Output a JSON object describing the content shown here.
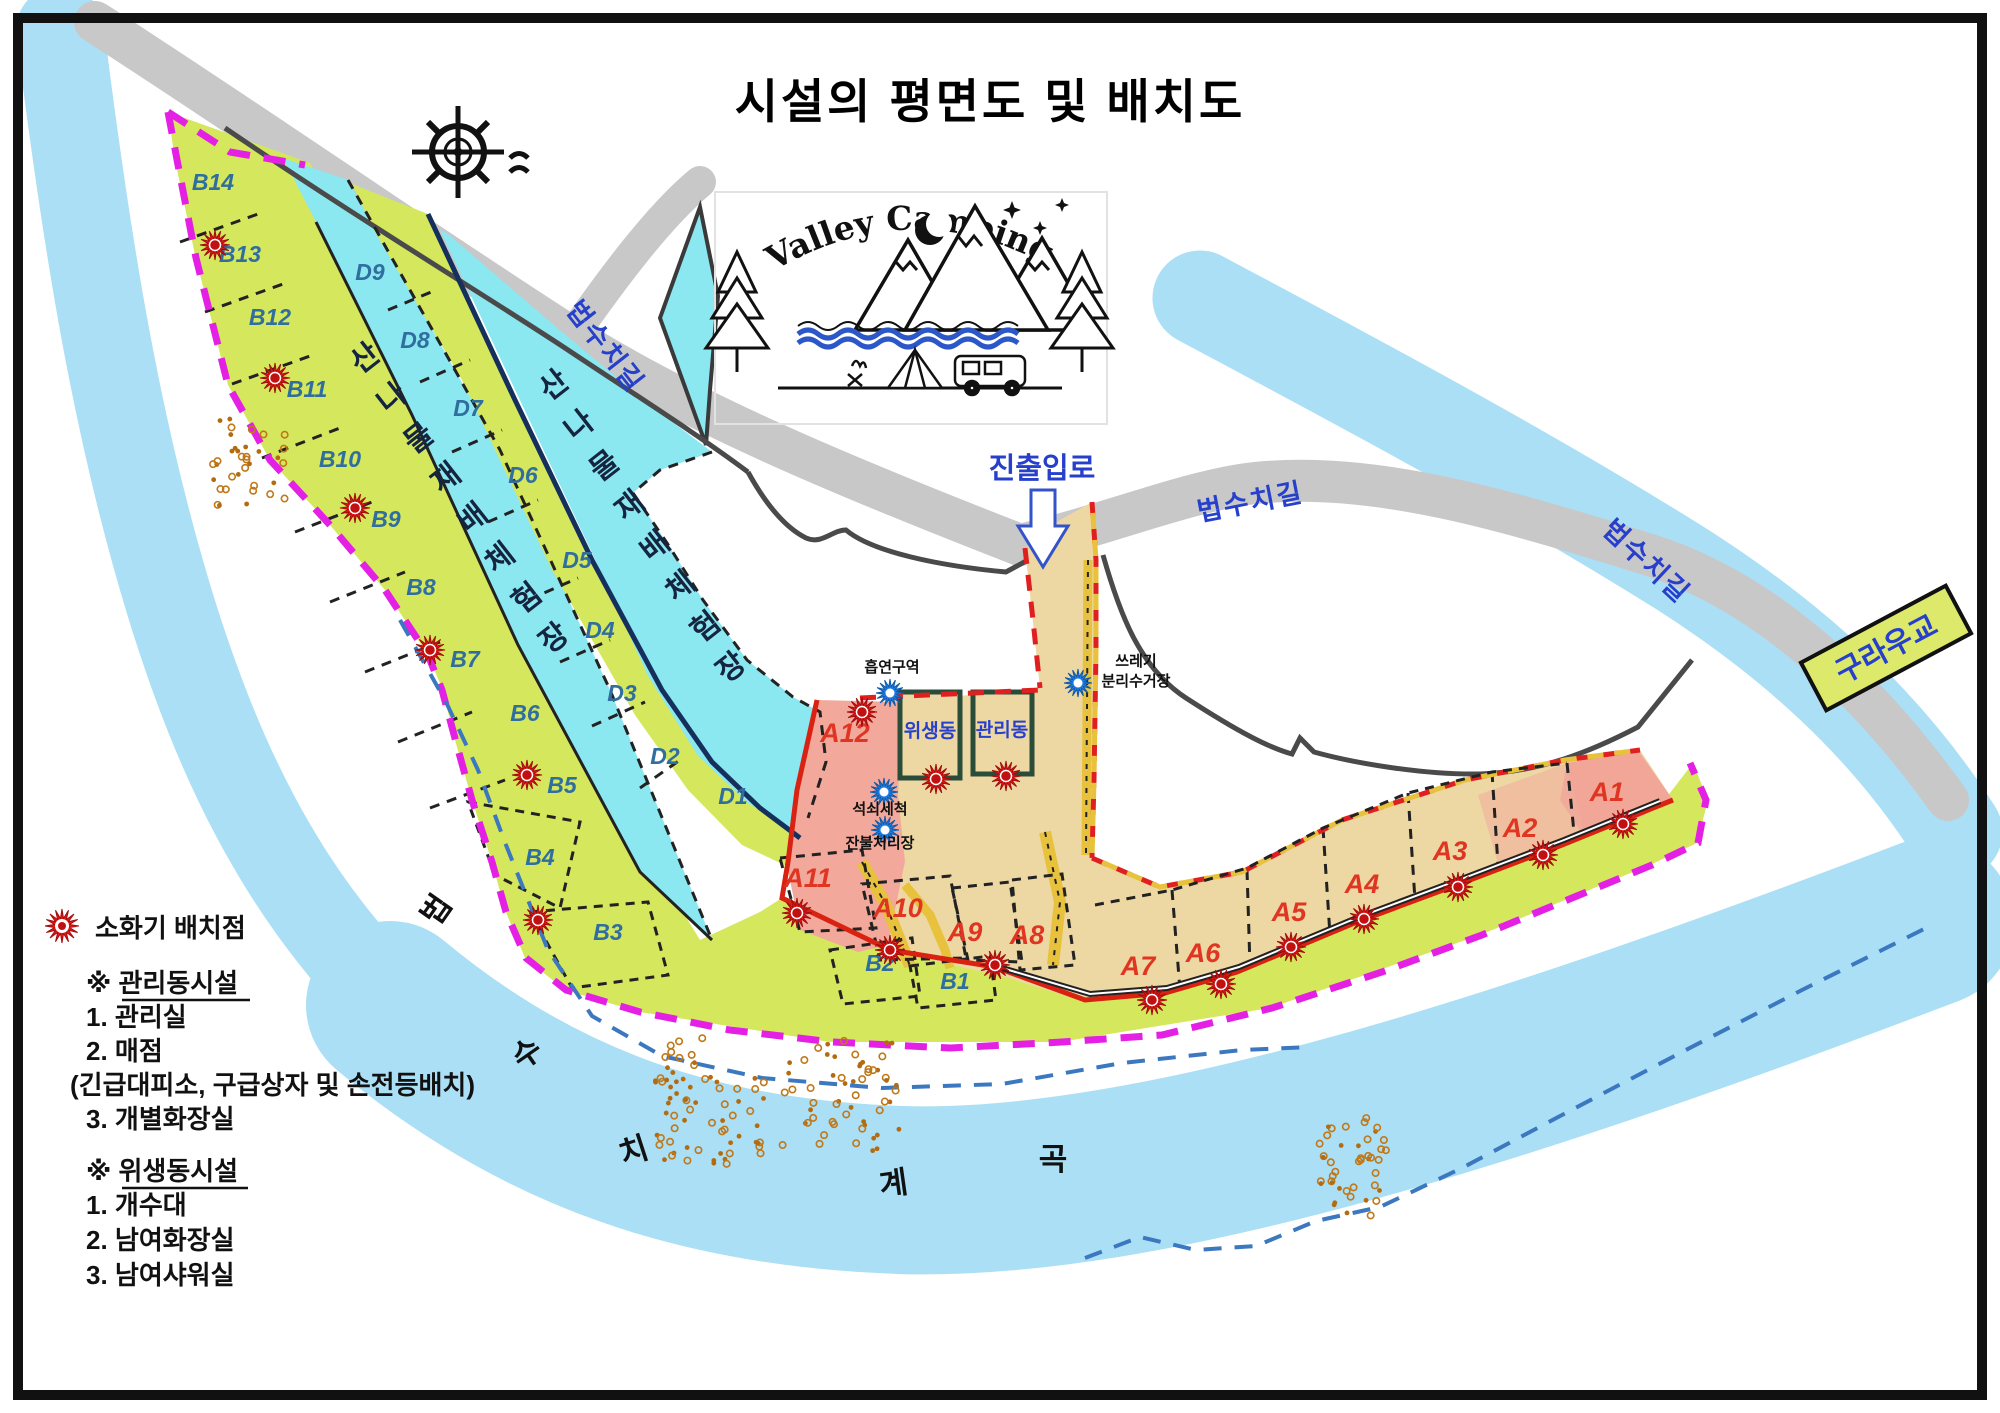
{
  "title": "시설의 평면도 및 배치도",
  "logo": {
    "name": "Valley Camping"
  },
  "roads": {
    "beopsuchi_1": "법수치길",
    "beopsuchi_2": "법수치길",
    "beopsuchi_3": "법수치길",
    "entrance": "진출입로",
    "bridge": "구라우교"
  },
  "river": {
    "name": "법수치계곡"
  },
  "areas": {
    "experience_1": "산나물재배체험장",
    "experience_2": "산나물재배체험장"
  },
  "buildings": {
    "sanitation": "위생동",
    "management": "관리동"
  },
  "poi": {
    "smoking": "흡연구역",
    "trash_line1": "쓰레기",
    "trash_line2": "분리수거장",
    "dishwash": "석쇠세척",
    "ember": "잔불처리장"
  },
  "sites": {
    "a": [
      "A1",
      "A2",
      "A3",
      "A4",
      "A5",
      "A6",
      "A7",
      "A8",
      "A9",
      "A10",
      "A11",
      "A12"
    ],
    "b": [
      "B1",
      "B2",
      "B3",
      "B4",
      "B5",
      "B6",
      "B7",
      "B8",
      "B9",
      "B10",
      "B11",
      "B12",
      "B13",
      "B14"
    ],
    "d": [
      "D1",
      "D2",
      "D3",
      "D4",
      "D5",
      "D6",
      "D7",
      "D8",
      "D9"
    ]
  },
  "legend": {
    "fire_ext": "소화기 배치점",
    "mgmt_title": "※ 관리동시설",
    "mgmt_items": [
      "1. 관리실",
      "2. 매점",
      "(긴급대피소, 구급상자 및 손전등배치)",
      "3. 개별화장실"
    ],
    "sani_title": "※ 위생동시설",
    "sani_items": [
      "1. 개수대",
      "2. 남여화장실",
      "3. 남여샤워실"
    ]
  },
  "colors": {
    "river": "#ABDFF5",
    "road": "#C8C8C8",
    "green": "#D5E75C",
    "cyan": "#8BE7F0",
    "tan": "#EDD7A2",
    "salmon": "#F2A89A",
    "magenta": "#E320E3",
    "red_line": "#D92211",
    "marker_red": "#E81515",
    "marker_blue": "#1F7FE8",
    "site_a": "#DF3522",
    "site_bd": "#2F6E9E",
    "label_blue": "#2740CC"
  }
}
